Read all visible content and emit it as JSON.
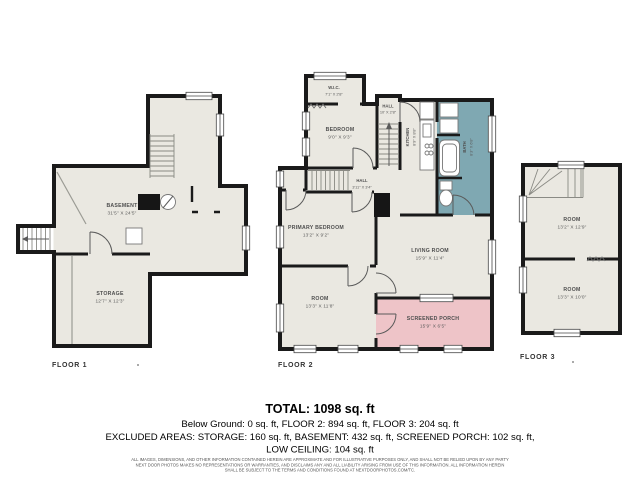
{
  "colors": {
    "floor_fill": "#eae8e1",
    "wall": "#1a1a1a",
    "bath_fill": "#7fa8b2",
    "porch_fill": "#eec4c8"
  },
  "floors": {
    "floor1": {
      "label": "FLOOR 1",
      "basement": {
        "name": "BASEMENT",
        "dims": "31'5\" X 24'5\""
      },
      "storage": {
        "name": "STORAGE",
        "dims": "12'7\" X 12'3\""
      }
    },
    "floor2": {
      "label": "FLOOR 2",
      "wic": {
        "name": "W.I.C.",
        "dims": "7'1\" X 2'8\""
      },
      "bedroom": {
        "name": "BEDROOM",
        "dims": "9'0\" X 9'3\""
      },
      "hall_upper": {
        "name": "HALL",
        "dims": "10' X 2'8\""
      },
      "kitchen": {
        "name": "KITCHEN",
        "dims": "8'9\" X 8'8\""
      },
      "bath": {
        "name": "BATH",
        "dims": "8'3\" X 6'8\""
      },
      "hall": {
        "name": "HALL",
        "dims": "3'11\" X 3'4\""
      },
      "primary_bedroom": {
        "name": "PRIMARY BEDROOM",
        "dims": "13'2\" X 9'2\""
      },
      "living_room": {
        "name": "LIVING ROOM",
        "dims": "15'9\" X 11'4\""
      },
      "room": {
        "name": "ROOM",
        "dims": "13'3\" X 11'8\""
      },
      "screened_porch": {
        "name": "SCREENED PORCH",
        "dims": "15'9\" X 6'5\""
      }
    },
    "floor3": {
      "label": "FLOOR 3",
      "room_upper": {
        "name": "ROOM",
        "dims": "13'2\" X 12'9\""
      },
      "room_lower": {
        "name": "ROOM",
        "dims": "13'3\" X 10'0\""
      }
    }
  },
  "summary": {
    "total": "TOTAL: 1098 sq. ft",
    "line2": "Below Ground: 0 sq. ft, FLOOR 2: 894 sq. ft, FLOOR 3: 204 sq. ft",
    "line3": "EXCLUDED AREAS: STORAGE: 160 sq. ft, BASEMENT: 432 sq. ft, SCREENED PORCH: 102 sq. ft,",
    "line4": "LOW CEILING: 104 sq. ft"
  },
  "disclaimer": {
    "line1": "ALL IMAGES, DIMENSIONS, AND OTHER INFORMATION CONTAINED HEREIN ARE APPROXIMATE AND FOR ILLUSTRATIVE PURPOSES ONLY, AND SHALL NOT BE RELIED UPON BY ANY PARTY",
    "line2": "NEXT DOOR PHOTOS MAKES NO REPRESENTATIONS OR WARRANTIES, AND DISCLAIMS ANY AND ALL LIABILITY ARISING FROM USE OF THIS INFORMATION. ALL INFORMATION HEREIN",
    "line3": "SHALL BE SUBJECT TO THE TERMS AND CONDITIONS FOUND AT NEXTDOORPHOTOS.COM/TC."
  }
}
